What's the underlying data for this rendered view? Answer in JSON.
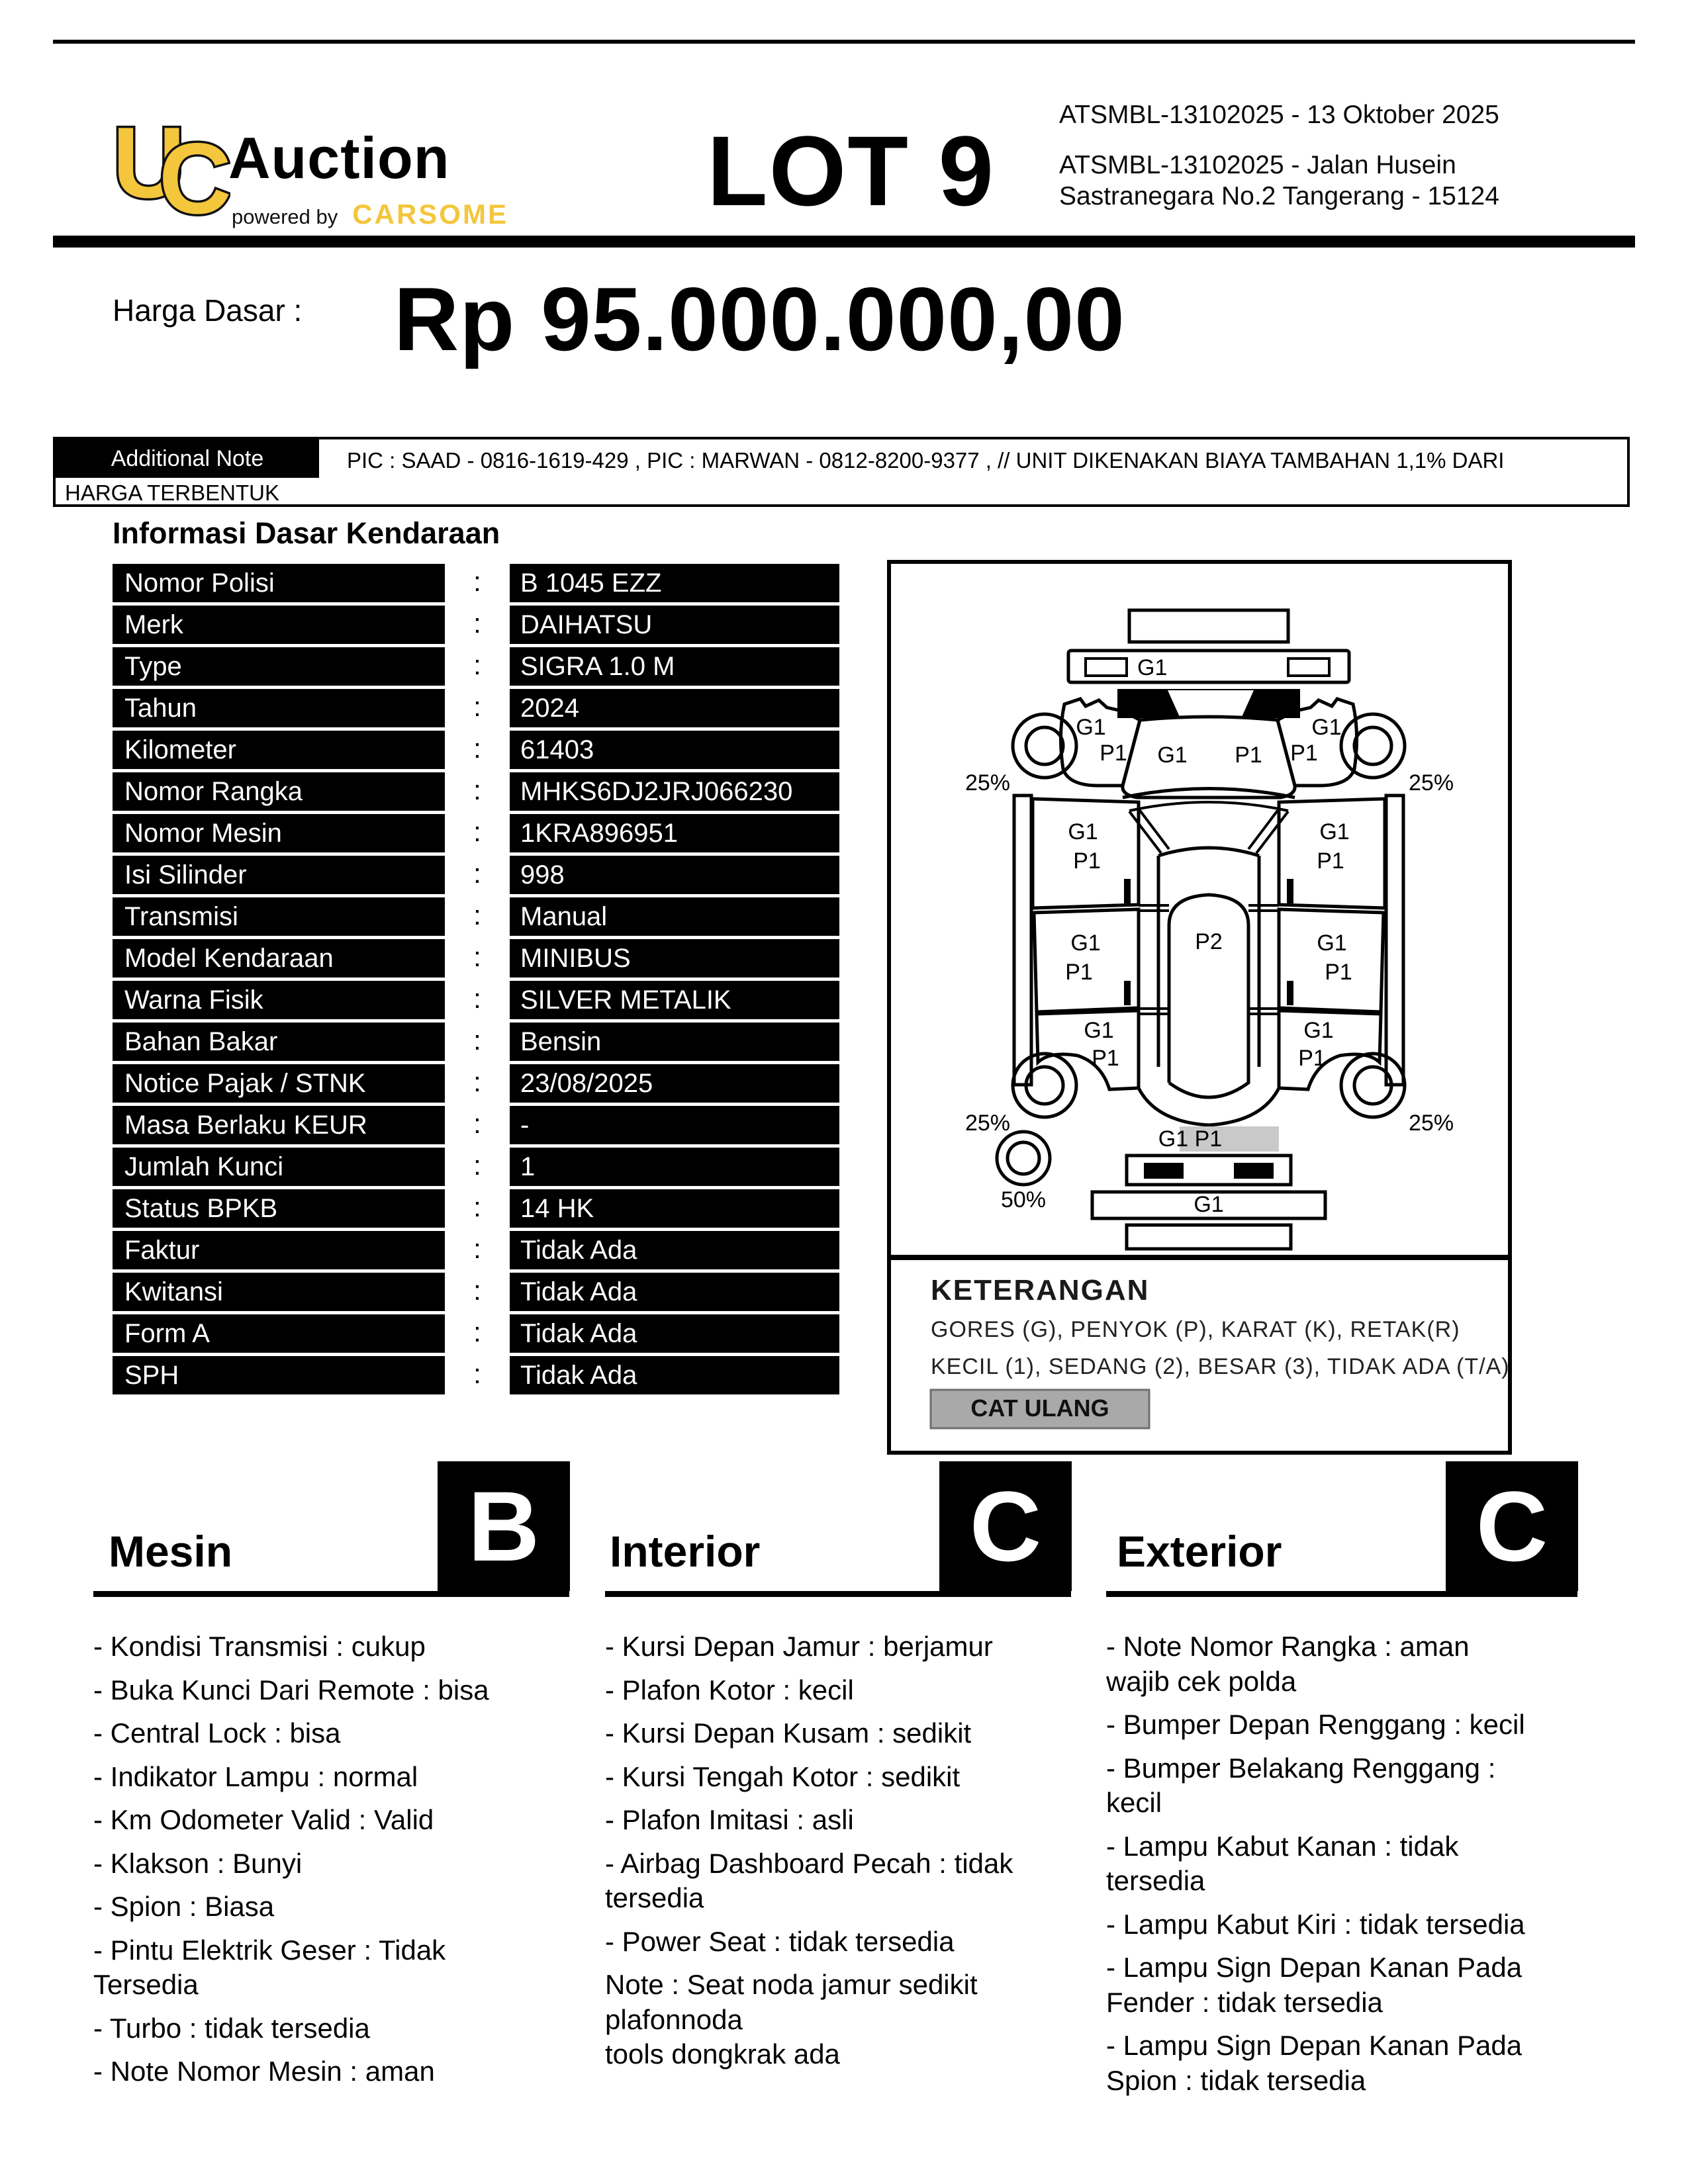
{
  "header": {
    "logo": {
      "monogram_u": "U",
      "monogram_c": "C",
      "brand": "Auction",
      "powered_by": "powered by",
      "carsome": "CARSOME"
    },
    "lot": "LOT 9",
    "line1": "ATSMBL-13102025 - 13 Oktober 2025",
    "line2": "ATSMBL-13102025 - Jalan Husein\nSastranegara No.2 Tangerang - 15124",
    "accent_color": "#f4c63c"
  },
  "price": {
    "label": "Harga Dasar :",
    "value": "Rp 95.000.000,00"
  },
  "additional_note": {
    "label": "Additional Note",
    "line1": "PIC : SAAD - 0816-1619-429  , PIC : MARWAN - 0812-8200-9377 ,  // UNIT DIKENAKAN BIAYA TAMBAHAN 1,1% DARI",
    "line2": "HARGA TERBENTUK"
  },
  "info": {
    "title": "Informasi Dasar Kendaraan",
    "colon": ":",
    "rows": [
      {
        "label": "Nomor Polisi",
        "value": "B 1045 EZZ"
      },
      {
        "label": "Merk",
        "value": "DAIHATSU"
      },
      {
        "label": "Type",
        "value": "SIGRA 1.0 M"
      },
      {
        "label": "Tahun",
        "value": "2024"
      },
      {
        "label": "Kilometer",
        "value": "61403"
      },
      {
        "label": "Nomor Rangka",
        "value": "MHKS6DJ2JRJ066230"
      },
      {
        "label": "Nomor Mesin",
        "value": "1KRA896951"
      },
      {
        "label": "Isi Silinder",
        "value": "998"
      },
      {
        "label": "Transmisi",
        "value": "Manual"
      },
      {
        "label": "Model Kendaraan",
        "value": "MINIBUS"
      },
      {
        "label": "Warna Fisik",
        "value": "SILVER METALIK"
      },
      {
        "label": "Bahan Bakar",
        "value": "Bensin"
      },
      {
        "label": "Notice Pajak / STNK",
        "value": "23/08/2025"
      },
      {
        "label": "Masa Berlaku KEUR",
        "value": "-"
      },
      {
        "label": "Jumlah Kunci",
        "value": "1"
      },
      {
        "label": "Status BPKB",
        "value": "14 HK"
      },
      {
        "label": "Faktur",
        "value": "Tidak Ada"
      },
      {
        "label": "Kwitansi",
        "value": "Tidak Ada"
      },
      {
        "label": "Form A",
        "value": "Tidak Ada"
      },
      {
        "label": "SPH",
        "value": "Tidak Ada"
      }
    ]
  },
  "diagram": {
    "front_bumper": "G1",
    "hood_g": "G1",
    "hood_p": "P1",
    "fender_fl_g": "G1",
    "fender_fl_p": "P1",
    "fender_fr_g": "G1",
    "fender_fr_p": "P1",
    "wheel_fl": "25%",
    "wheel_fr": "25%",
    "door_fl_g": "G1",
    "door_fl_p": "P1",
    "door_fr_g": "G1",
    "door_fr_p": "P1",
    "roof": "P2",
    "door_rl_g": "G1",
    "door_rl_p": "P1",
    "door_rr_g": "G1",
    "door_rr_p": "P1",
    "quarter_rl_g": "G1",
    "quarter_rl_p": "P1",
    "quarter_rr_g": "G1",
    "quarter_rr_p": "P1",
    "wheel_rl": "25%",
    "wheel_rr": "25%",
    "tailgate": "G1 P1",
    "rear_bumper_lower": "G1",
    "spare": "50%",
    "keterangan": {
      "title": "KETERANGAN",
      "line1": "GORES (G), PENYOK (P), KARAT (K), RETAK(R)",
      "line2": "KECIL (1), SEDANG (2), BESAR (3), TIDAK ADA (T/A)",
      "cat_ulang": "CAT ULANG",
      "cat_ulang_color": "#a9a9a9"
    }
  },
  "sections": [
    {
      "title": "Mesin",
      "grade": "B",
      "items": [
        "- Kondisi Transmisi : cukup",
        "- Buka Kunci Dari Remote : bisa",
        "- Central Lock : bisa",
        "- Indikator Lampu : normal",
        "- Km Odometer Valid : Valid",
        "- Klakson : Bunyi",
        "- Spion : Biasa",
        "- Pintu Elektrik Geser : Tidak\nTersedia",
        "- Turbo : tidak tersedia",
        "- Note Nomor Mesin : aman"
      ]
    },
    {
      "title": "Interior",
      "grade": "C",
      "items": [
        "- Kursi Depan Jamur : berjamur",
        "- Plafon Kotor : kecil",
        "- Kursi Depan Kusam : sedikit",
        "- Kursi Tengah Kotor : sedikit",
        "- Plafon Imitasi : asli",
        "- Airbag Dashboard Pecah : tidak\ntersedia",
        "- Power Seat : tidak tersedia",
        "Note : Seat noda jamur sedikit\nplafonnoda\ntools dongkrak ada"
      ]
    },
    {
      "title": "Exterior",
      "grade": "C",
      "items": [
        "- Note Nomor Rangka : aman\nwajib cek polda",
        "- Bumper Depan Renggang : kecil",
        "- Bumper Belakang Renggang :\nkecil",
        "- Lampu Kabut Kanan : tidak\ntersedia",
        "- Lampu Kabut Kiri : tidak tersedia",
        "- Lampu Sign Depan Kanan Pada\nFender : tidak tersedia",
        "- Lampu Sign Depan Kanan Pada\nSpion : tidak tersedia"
      ]
    }
  ]
}
